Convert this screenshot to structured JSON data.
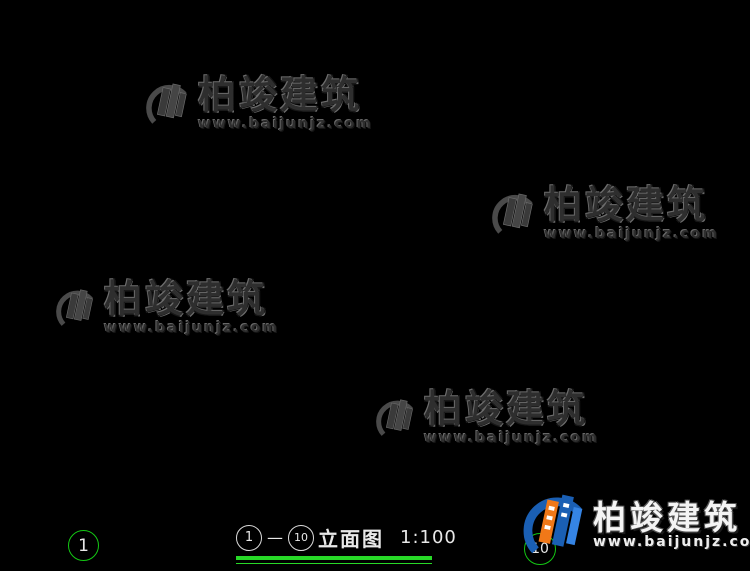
{
  "watermark": {
    "text": "柏竣建筑",
    "url": "www.baijunjz.com"
  },
  "title": {
    "axis_from": "1",
    "axis_to": "10",
    "dash": "—",
    "name": "立面图",
    "scale": "1:100"
  },
  "axis_bubbles": {
    "left": "1",
    "right": "10"
  },
  "bottom_dim": {
    "label": "13740",
    "tx": 307,
    "ty": 497,
    "y": 503,
    "x1": 123,
    "x2": 543
  },
  "colors": {
    "line": "#d9d9d9",
    "bright": "#ffffff",
    "green": "#17d117",
    "brick": "#b96a5e",
    "frame_blue": "#3a85c0",
    "glass_cyan": "#00b9b9",
    "steps_yellow": "#b8b832",
    "logo_blue": "#1a5fb4",
    "logo_light_blue": "#3584e4",
    "logo_orange": "#f07818"
  },
  "levels": [
    {
      "t": "12.522",
      "tx": 257,
      "ty": 23,
      "x1": 228,
      "x2": 292,
      "ly": 28,
      "tri": 250
    },
    {
      "t": "12.189",
      "tx": 377,
      "ty": 37,
      "x1": 348,
      "x2": 406,
      "ly": 42,
      "tri": 355
    },
    {
      "t": "12.800",
      "tx": 713,
      "ty": 17,
      "x1": 666,
      "x2": 748,
      "ly": 23,
      "tri": 681
    },
    {
      "t": "10.400",
      "tx": 445,
      "ty": 96,
      "x1": 414,
      "x2": 472,
      "ly": 101,
      "tri": 426
    },
    {
      "t": "10.400",
      "tx": 714,
      "ty": 96,
      "x1": 666,
      "x2": 748,
      "ly": 101,
      "tri": 681
    },
    {
      "t": "9.800",
      "tx": 170,
      "ty": 117,
      "x1": 146,
      "x2": 198,
      "ly": 122,
      "tri": 170
    },
    {
      "t": "9.800",
      "tx": 282,
      "ty": 118,
      "x1": 256,
      "x2": 308,
      "ly": 123,
      "tri": 280
    },
    {
      "t": "9.800",
      "tx": 398,
      "ty": 118,
      "x1": 372,
      "x2": 424,
      "ly": 123,
      "tri": 396
    },
    {
      "t": "8.000",
      "tx": 170,
      "ty": 179,
      "x1": 142,
      "x2": 198,
      "ly": 184,
      "tri": 168
    },
    {
      "t": "8.000",
      "tx": 280,
      "ty": 179,
      "x1": 252,
      "x2": 308,
      "ly": 184,
      "tri": 278
    },
    {
      "t": "8.150",
      "tx": 434,
      "ty": 173,
      "x1": 402,
      "x2": 456,
      "ly": 178,
      "tri": 420
    },
    {
      "t": "8.350",
      "tx": 499,
      "ty": 164,
      "x1": 474,
      "x2": 524,
      "ly": 169,
      "tri": 498
    },
    {
      "t": "7.100",
      "tx": 714,
      "ty": 209,
      "x1": 670,
      "x2": 748,
      "ly": 214,
      "tri": 684
    },
    {
      "t": "6.500",
      "tx": 170,
      "ty": 227,
      "x1": 128,
      "x2": 198,
      "ly": 232,
      "tri": 142
    },
    {
      "t": "6.500",
      "tx": 380,
      "ty": 226,
      "x1": 342,
      "x2": 406,
      "ly": 231,
      "tri": 356
    },
    {
      "t": "6.500",
      "tx": 625,
      "ty": 226,
      "x1": 598,
      "x2": 652,
      "ly": 231,
      "tri": 610
    },
    {
      "t": "4.850",
      "tx": 282,
      "ty": 282,
      "x1": 252,
      "x2": 310,
      "ly": 287,
      "tri": 264
    },
    {
      "t": "4.850",
      "tx": 383,
      "ty": 282,
      "x1": 346,
      "x2": 410,
      "ly": 287,
      "tri": 358
    },
    {
      "t": "4.700",
      "tx": 172,
      "ty": 288,
      "x1": 144,
      "x2": 200,
      "ly": 293,
      "tri": 158
    },
    {
      "t": "5.050",
      "tx": 542,
      "ty": 274,
      "x1": 506,
      "x2": 566,
      "ly": 279,
      "tri": 518
    },
    {
      "t": "4.000",
      "tx": 554,
      "ty": 310,
      "x1": 512,
      "x2": 578,
      "ly": 315,
      "tri": 524
    },
    {
      "t": "3.800",
      "tx": 716,
      "ty": 314,
      "x1": 670,
      "x2": 748,
      "ly": 319,
      "tri": 684
    },
    {
      "t": "3.400",
      "tx": 283,
      "ty": 328,
      "x1": 240,
      "x2": 306,
      "ly": 333,
      "tri": 252
    },
    {
      "t": "3.200",
      "tx": 172,
      "ty": 337,
      "x1": 128,
      "x2": 198,
      "ly": 342,
      "tri": 140
    },
    {
      "t": "3.200",
      "tx": 433,
      "ty": 337,
      "x1": 390,
      "x2": 454,
      "ly": 342,
      "tri": 404
    },
    {
      "t": "2.500",
      "tx": 261,
      "ty": 362,
      "x1": 230,
      "x2": 290,
      "ly": 367,
      "tri": 246
    },
    {
      "t": "0.400",
      "tx": 170,
      "ty": 430,
      "x1": 128,
      "x2": 198,
      "ly": 435,
      "tri": 142
    },
    {
      "t": "0.400",
      "tx": 431,
      "ty": 430,
      "x1": 388,
      "x2": 454,
      "ly": 435,
      "tri": 400
    },
    {
      "t": "±0.000",
      "tx": 713,
      "ty": 443,
      "x1": 664,
      "x2": 748,
      "ly": 449,
      "tri": 680
    }
  ],
  "dim_chains": [
    {
      "x": 603,
      "label_x": 593,
      "ticks": [
        105,
        126,
        188,
        219,
        240,
        302,
        333,
        354,
        451,
        465,
        478
      ],
      "labels": [
        {
          "t": "600",
          "y": 115
        },
        {
          "t": "1800",
          "y": 157
        },
        {
          "t": "900",
          "y": 203
        },
        {
          "t": "600",
          "y": 229
        },
        {
          "t": "1800",
          "y": 271
        },
        {
          "t": "900",
          "y": 317
        },
        {
          "t": "600",
          "y": 343
        },
        {
          "t": "2800",
          "y": 402
        },
        {
          "t": "400",
          "y": 458
        }
      ]
    },
    {
      "x": 631,
      "label_x": 620,
      "ticks": [
        23,
        105,
        219,
        333,
        465,
        478
      ],
      "labels": [
        {
          "t": "2400",
          "y": 64
        },
        {
          "t": "3300",
          "y": 162
        },
        {
          "t": "3300",
          "y": 276
        },
        {
          "t": "3800",
          "y": 399
        }
      ]
    },
    {
      "x": 657,
      "label_x": 647,
      "ticks": [
        23,
        478
      ],
      "labels": [
        {
          "t": "13250",
          "y": 261
        }
      ]
    }
  ],
  "below_ground_dims": [
    {
      "t": "450",
      "x": 599,
      "y": 497
    },
    {
      "t": "450",
      "x": 636,
      "y": 497
    }
  ],
  "extension_lines": [
    [
      566,
      23,
      746
    ],
    [
      560,
      105,
      746
    ],
    [
      545,
      126,
      662
    ],
    [
      545,
      188,
      662
    ],
    [
      584,
      219,
      746
    ],
    [
      545,
      240,
      662
    ],
    [
      545,
      302,
      662
    ],
    [
      543,
      333,
      746
    ],
    [
      545,
      354,
      662
    ],
    [
      545,
      451,
      662
    ],
    [
      548,
      465,
      746
    ],
    [
      648,
      478,
      662
    ]
  ],
  "green_dots": [
    [
      237,
      143
    ],
    [
      332,
      55
    ],
    [
      490,
      196
    ],
    [
      368,
      252
    ],
    [
      550,
      300
    ],
    [
      152,
      420
    ],
    [
      466,
      410
    ],
    [
      95,
      255
    ],
    [
      435,
      128
    ]
  ]
}
